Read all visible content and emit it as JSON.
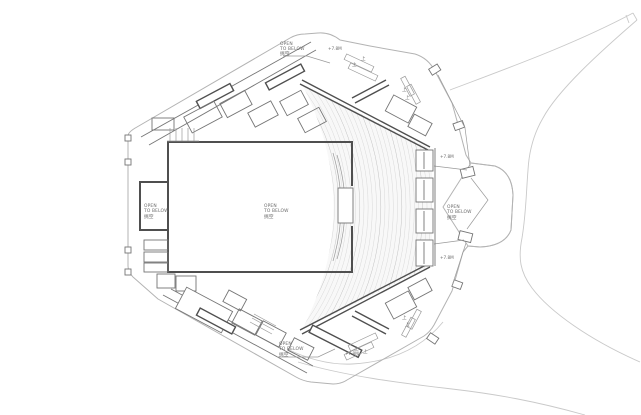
{
  "drawing": {
    "type_note": "architectural floor plan, upper level of an auditorium / theatre",
    "colors": {
      "background": "#ffffff",
      "wall_dark": "#4f4f4f",
      "wall_medium": "#757575",
      "outline_light": "#b3b3b3",
      "site_line": "#c9c9c9",
      "seat_row_line": "#d9d9d9",
      "text": "#6b6b6b"
    }
  },
  "annotations": {
    "open_to_below_labels": [
      {
        "line1": "OPEN",
        "line2": "TO BELOW",
        "line3": "挑空"
      },
      {
        "line1": "OPEN",
        "line2": "TO BELOW",
        "line3": "挑空"
      },
      {
        "line1": "OPEN",
        "line2": "TO BELOW",
        "line3": "挑空"
      },
      {
        "line1": "OPEN",
        "line2": "TO BELOW",
        "line3": "挑空"
      },
      {
        "line1": "OPEN",
        "line2": "TO BELOW",
        "line3": "挑空"
      }
    ],
    "elevation_labels": [
      "+7.8M",
      "+7.8M",
      "+7.8M",
      "+7.8M"
    ],
    "stair_up_labels": [
      "上",
      "上",
      "上",
      "上",
      "上",
      "上",
      "上",
      "上"
    ]
  }
}
